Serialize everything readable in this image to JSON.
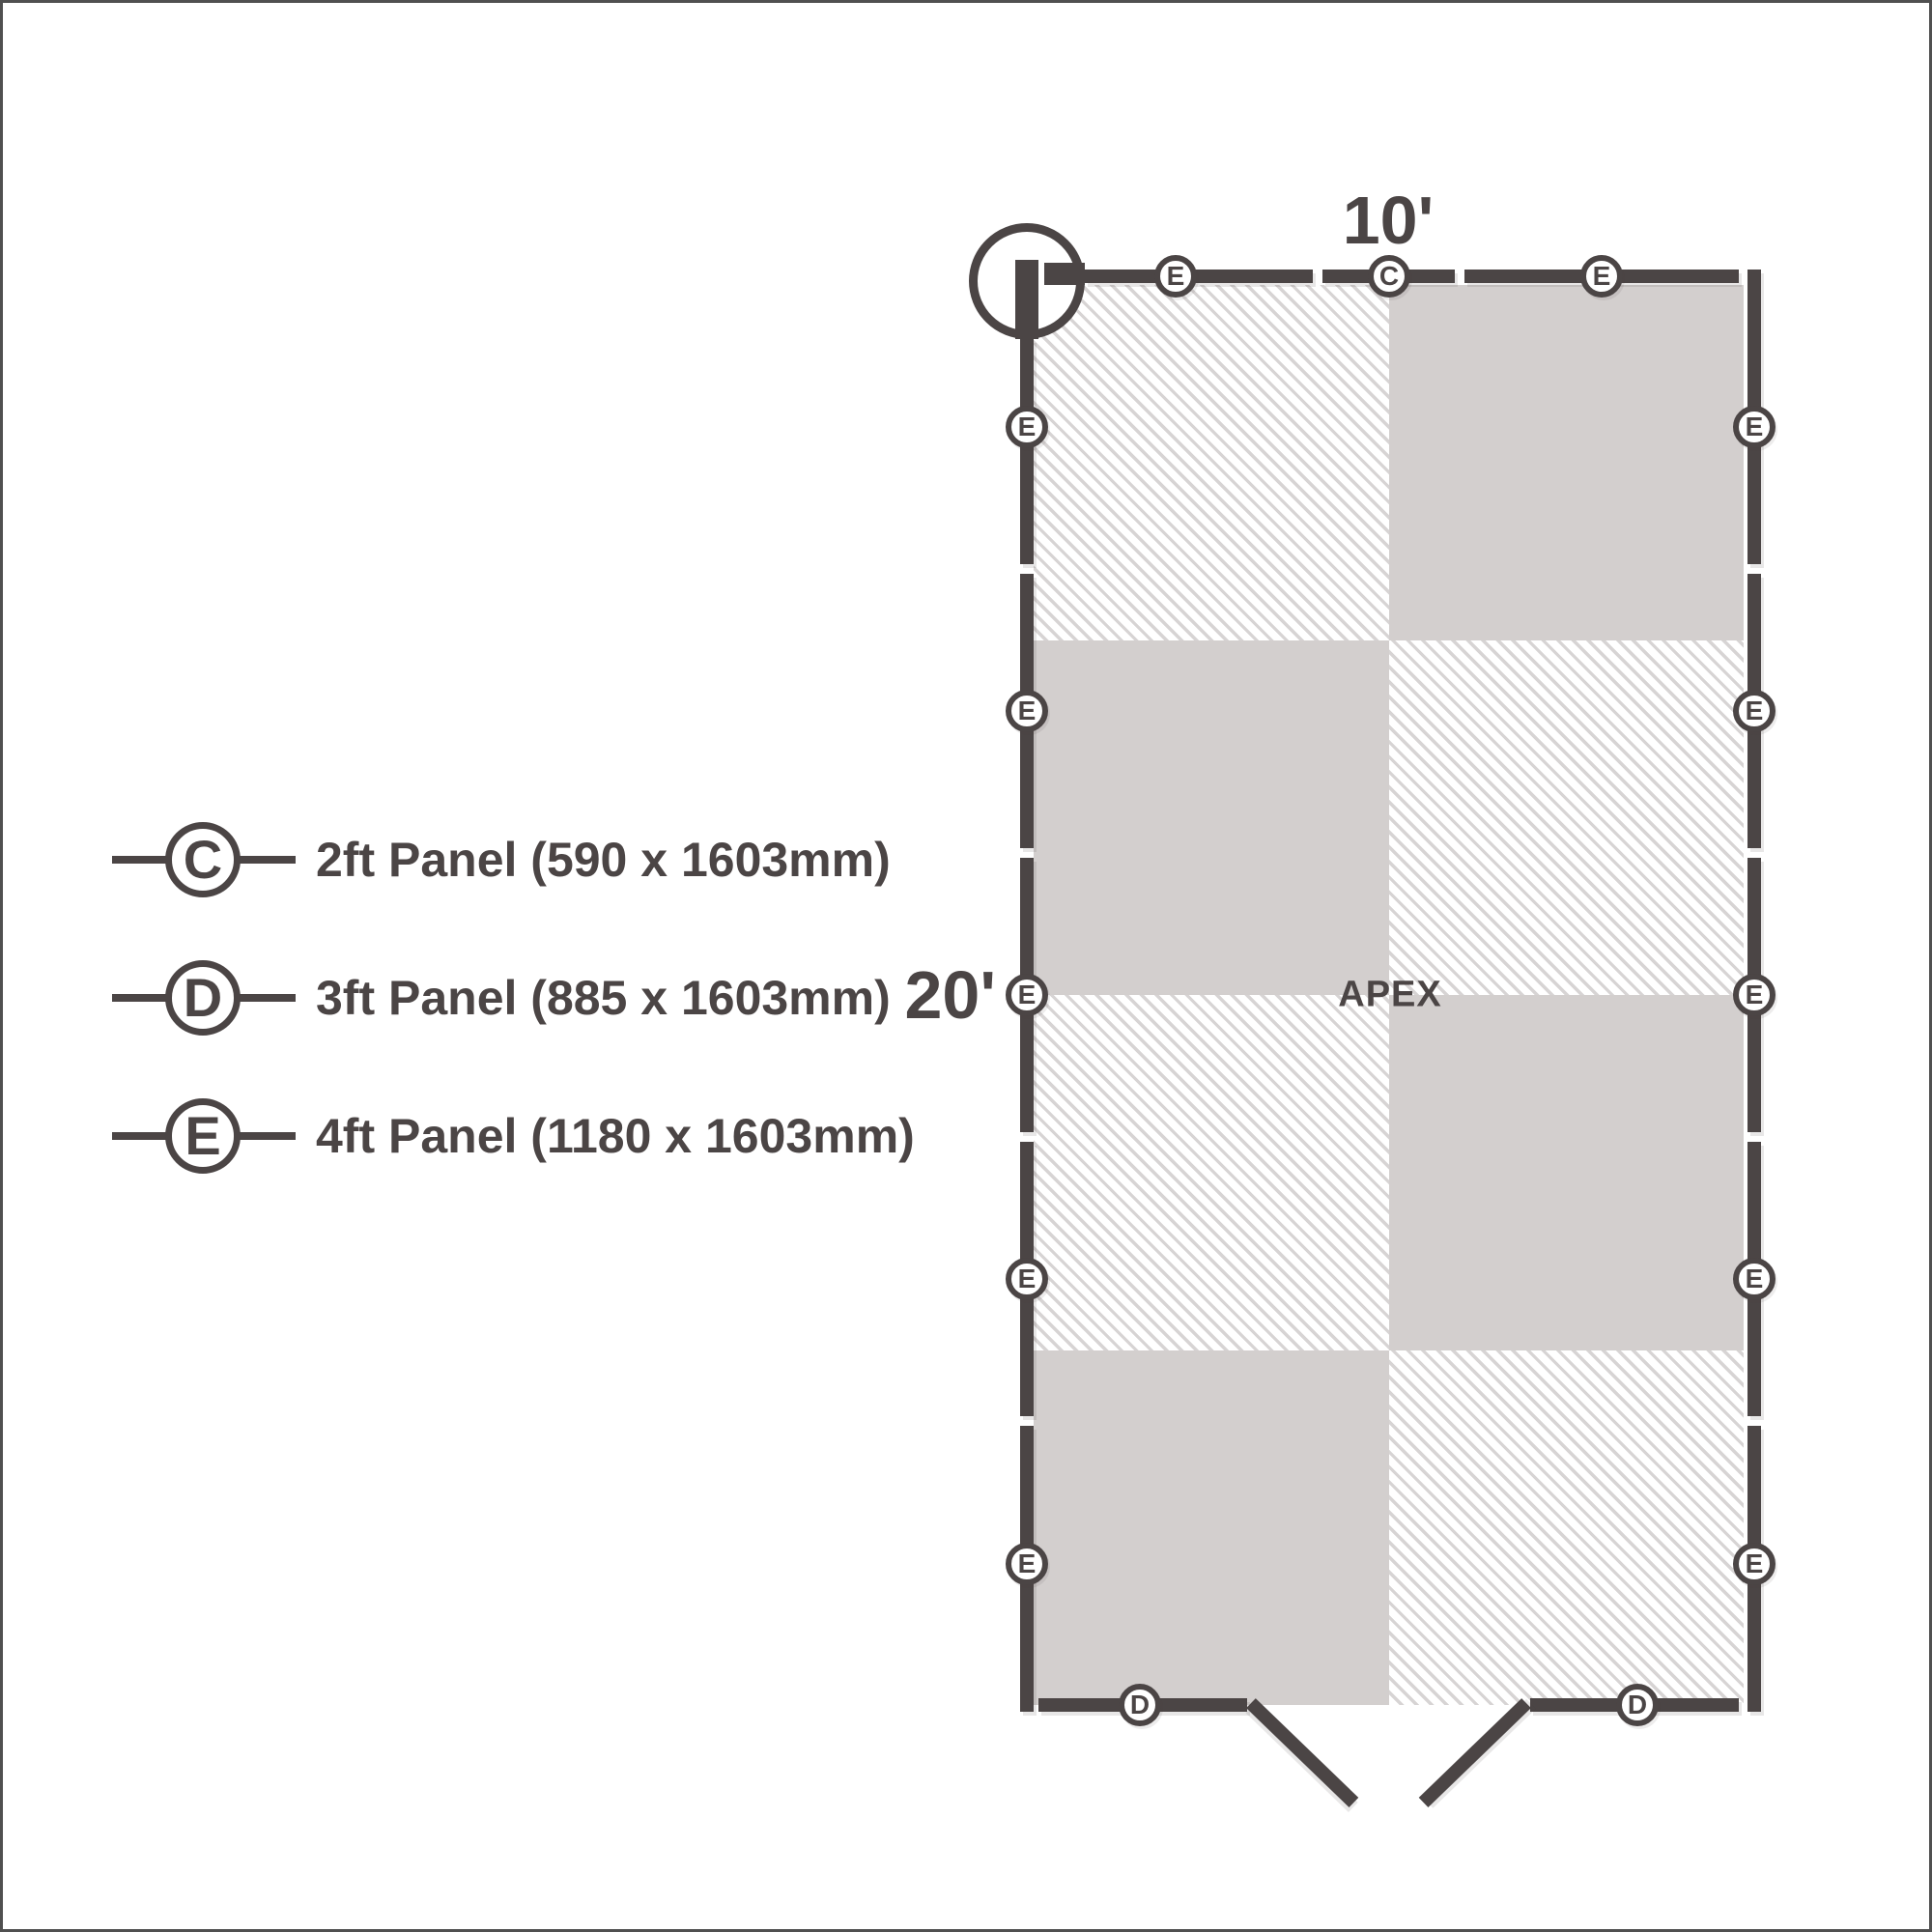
{
  "legend": {
    "items": [
      {
        "code": "C",
        "label": "2ft Panel (590 x 1603mm)"
      },
      {
        "code": "D",
        "label": "3ft Panel (885 x 1603mm)"
      },
      {
        "code": "E",
        "label": "4ft Panel (1180 x 1603mm)"
      }
    ]
  },
  "plan": {
    "top_dimension": "10'",
    "side_dimension": "20'",
    "apex_label": "APEX",
    "walls": {
      "top": {
        "markers": [
          "E",
          "C",
          "E"
        ]
      },
      "left": {
        "markers": [
          "E",
          "E",
          "E",
          "E",
          "E"
        ]
      },
      "right": {
        "markers": [
          "E",
          "E",
          "E",
          "E",
          "E"
        ]
      },
      "bottom": {
        "markers": [
          "D",
          "D"
        ]
      }
    }
  },
  "colors": {
    "ink": "#4b4545",
    "cell_solid": "#d3cfce",
    "hatch_stripe": "#d7d4d4",
    "frame": "#505050",
    "background": "#ffffff"
  }
}
